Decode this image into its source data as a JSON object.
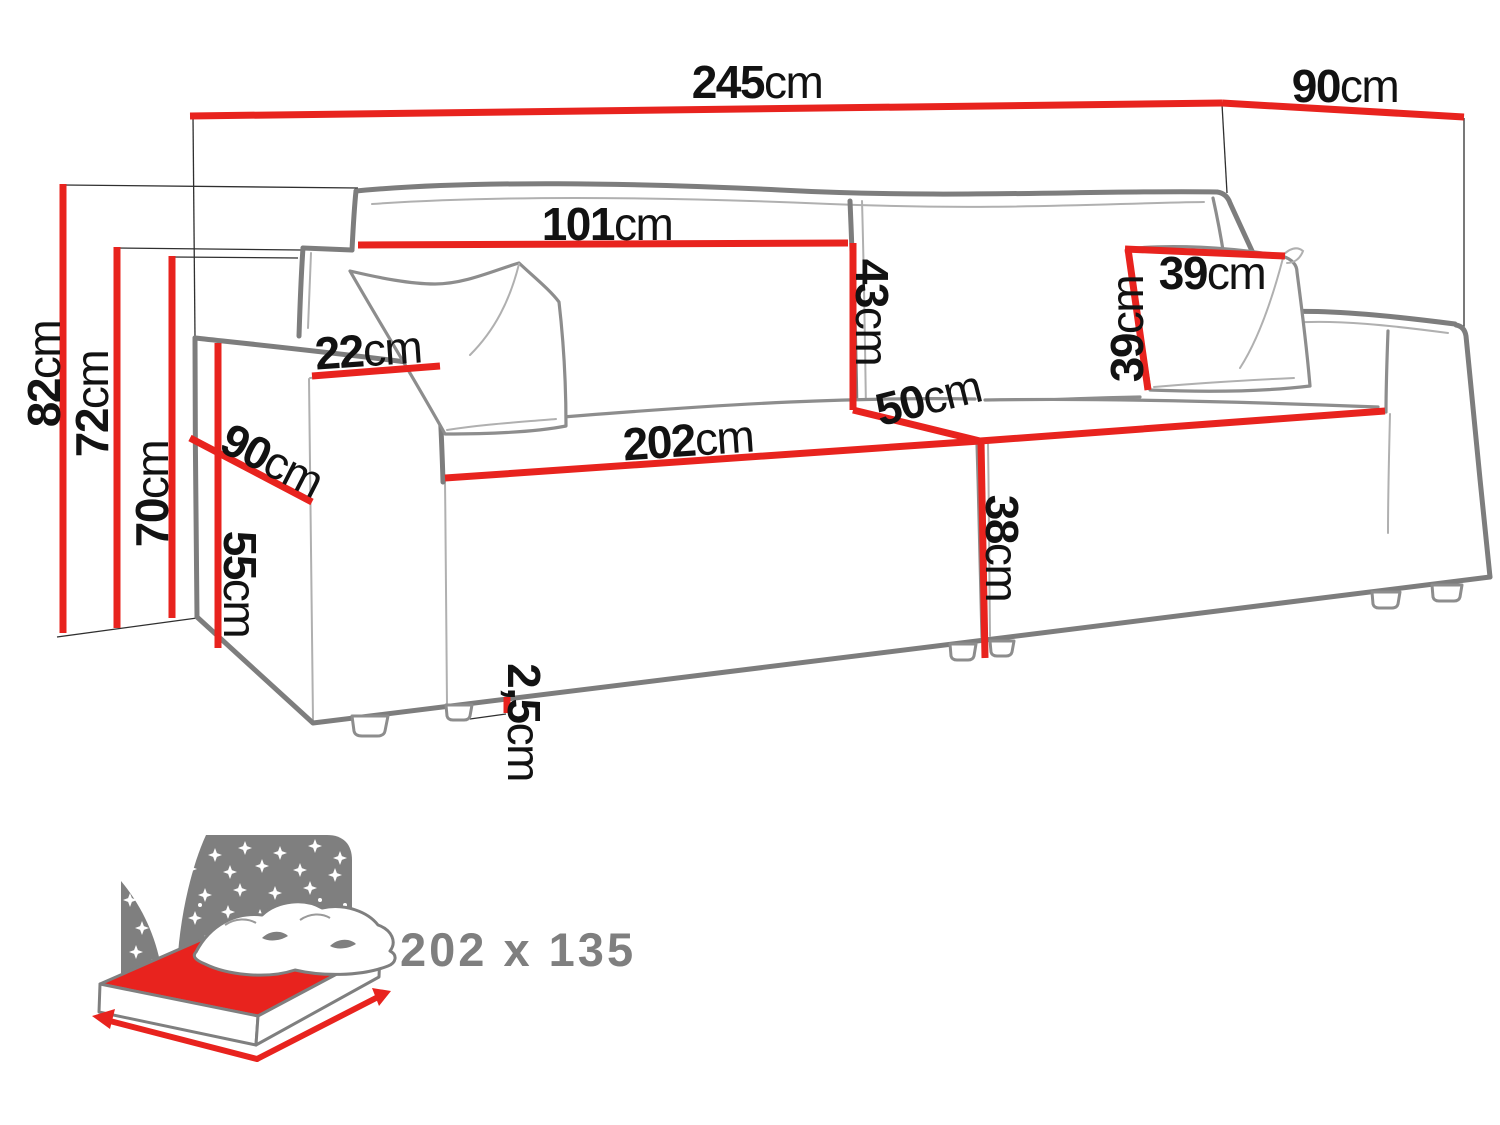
{
  "diagram": {
    "colors": {
      "dimension_red": "#e8231e",
      "outline_gray": "#7d7d7d",
      "construction_line": "#2f2f2f",
      "label_black": "#121212",
      "icon_gray": "#7f7f7f"
    },
    "dimensions": {
      "total_width": {
        "value": "245",
        "unit": "cm"
      },
      "total_depth": {
        "value": "90",
        "unit": "cm"
      },
      "backrest_width": {
        "value": "101",
        "unit": "cm"
      },
      "back_cushion_height": {
        "value": "43",
        "unit": "cm"
      },
      "pillow_width": {
        "value": "39",
        "unit": "cm"
      },
      "pillow_height": {
        "value": "39",
        "unit": "cm"
      },
      "armrest_width": {
        "value": "22",
        "unit": "cm"
      },
      "armrest_depth": {
        "value": "90",
        "unit": "cm"
      },
      "seat_width": {
        "value": "202",
        "unit": "cm"
      },
      "seat_depth": {
        "value": "50",
        "unit": "cm"
      },
      "seat_front_height": {
        "value": "38",
        "unit": "cm"
      },
      "total_height": {
        "value": "82",
        "unit": "cm"
      },
      "backrest_height": {
        "value": "72",
        "unit": "cm"
      },
      "back_height": {
        "value": "70",
        "unit": "cm"
      },
      "armrest_height": {
        "value": "55",
        "unit": "cm"
      },
      "leg_height": {
        "value": "2,5",
        "unit": "cm"
      }
    },
    "sleeping_area": {
      "label": "202 x 135"
    }
  }
}
